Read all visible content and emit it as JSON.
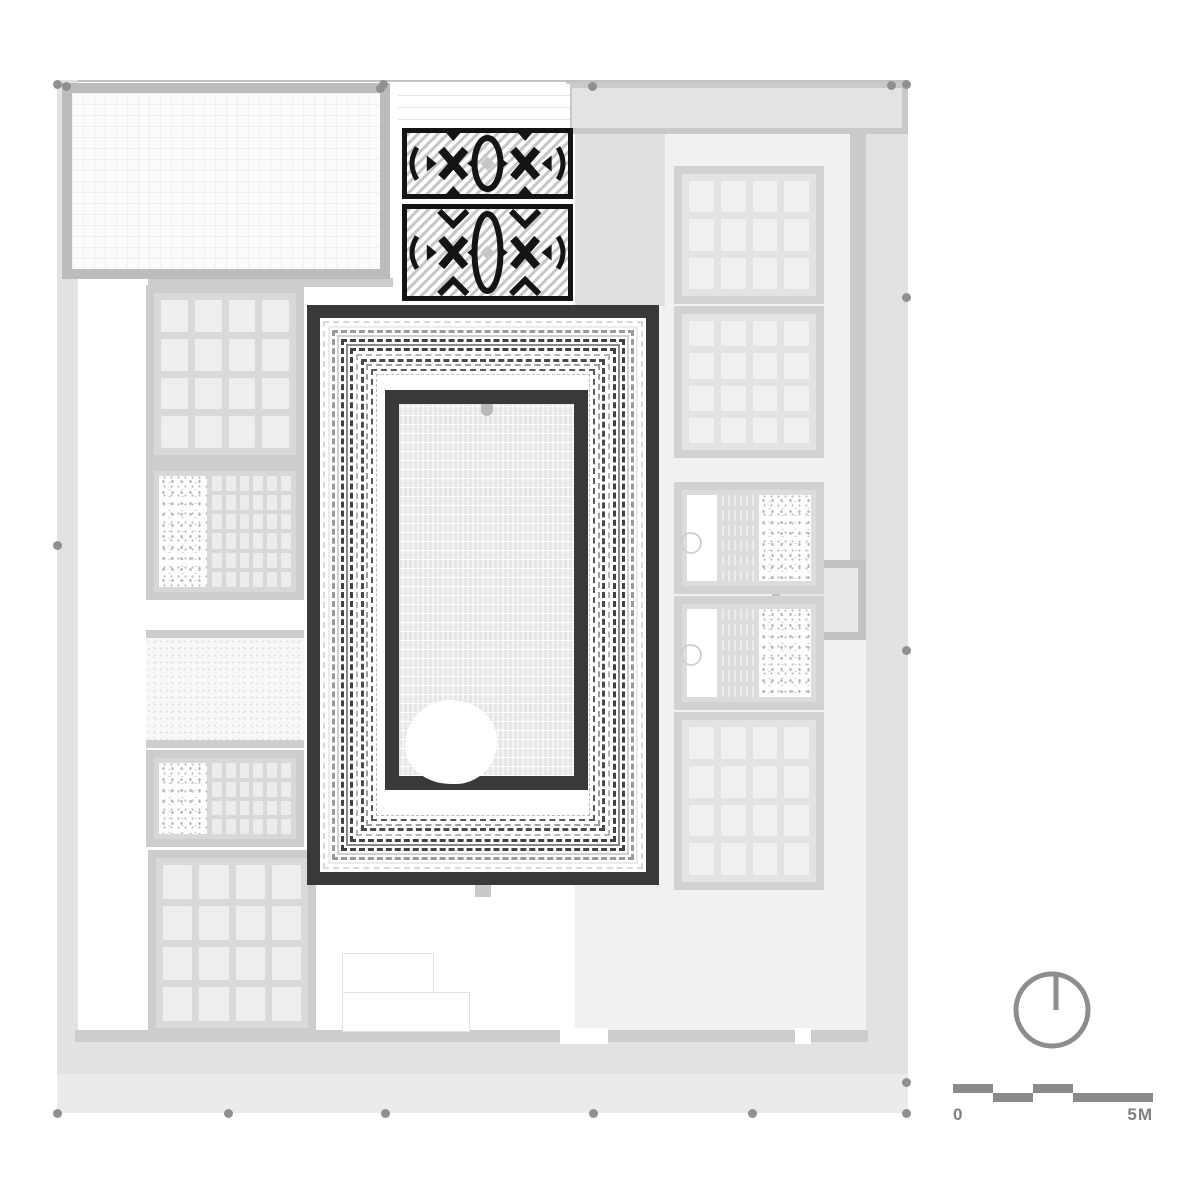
{
  "drawing": {
    "type": "architectural-roof-plan",
    "accent_dark": "#37393b",
    "wall_gray": "#cdcdcd",
    "terrace_gray": "#e2e2e2",
    "ornament_black": "#141414",
    "ornament_stripe": "#c6c6c6"
  },
  "scalebar": {
    "start_label": "0",
    "end_label": "5M",
    "color": "#8a8a8a",
    "x": 953,
    "y": 1084,
    "length": 200,
    "seg_h": 9,
    "segments": [
      {
        "off": 0,
        "w": 40,
        "row": "top"
      },
      {
        "off": 40,
        "w": 40,
        "row": "bot"
      },
      {
        "off": 80,
        "w": 40,
        "row": "top"
      },
      {
        "off": 120,
        "w": 80,
        "row": "bot"
      }
    ]
  },
  "north_arrow": {
    "cx": 1052,
    "cy": 1010,
    "r": 36,
    "stroke": "#8d8d8d",
    "stroke_w": 5
  },
  "geometry": {
    "site": {
      "x": 57,
      "y": 80,
      "w": 851,
      "h": 1033,
      "stroke": "#c2c2c2"
    },
    "rects": [
      {
        "name": "west-terrace",
        "x": 57,
        "y": 80,
        "w": 21,
        "h": 1033,
        "fill": "#e2e2e2"
      },
      {
        "name": "east-terrace",
        "x": 866,
        "y": 82,
        "w": 42,
        "h": 1031,
        "fill": "#e2e2e2"
      },
      {
        "name": "south-terrace",
        "x": 57,
        "y": 1040,
        "w": 851,
        "h": 73,
        "fill": "#e2e2e2"
      },
      {
        "name": "south-terrace-light",
        "x": 57,
        "y": 1074,
        "w": 851,
        "h": 39,
        "fill": "#ebebeb"
      },
      {
        "name": "north-entry-block",
        "x": 566,
        "y": 82,
        "w": 342,
        "h": 52,
        "fill": "#e3e3e3",
        "bw": 6,
        "bc": "#c9c9c9"
      },
      {
        "name": "right-wing-bg",
        "x": 575,
        "y": 134,
        "w": 291,
        "h": 906,
        "fill": "#f1f1f1"
      },
      {
        "name": "right-mid-band",
        "x": 575,
        "y": 134,
        "w": 90,
        "h": 172,
        "fill": "#e0e0e0"
      },
      {
        "name": "east-wall",
        "x": 850,
        "y": 134,
        "w": 16,
        "h": 434,
        "fill": "#cbcbcb"
      },
      {
        "name": "east-annex",
        "x": 772,
        "y": 560,
        "w": 94,
        "h": 80,
        "fill": "#e8e8e8",
        "bw": 8,
        "bc": "#c2c2c2"
      },
      {
        "name": "west-wall-band",
        "x": 148,
        "y": 278,
        "w": 245,
        "h": 9,
        "fill": "#cdcdcd"
      },
      {
        "name": "south-wall-band",
        "x": 75,
        "y": 1030,
        "w": 793,
        "h": 12,
        "fill": "#cdcdcd"
      },
      {
        "name": "south-door-gap",
        "x": 560,
        "y": 1028,
        "w": 48,
        "h": 16,
        "fill": "#ffffff"
      },
      {
        "name": "south-door-gap-2",
        "x": 795,
        "y": 1028,
        "w": 16,
        "h": 16,
        "fill": "#ffffff"
      },
      {
        "name": "axis-tab-south",
        "x": 475,
        "y": 885,
        "w": 16,
        "h": 12,
        "fill": "#c9c9c9"
      }
    ],
    "great_hall": {
      "x": 62,
      "y": 83,
      "w": 328,
      "h": 196,
      "bw": 10,
      "wall": "#bcbcbc"
    },
    "entrance": {
      "x": 398,
      "y": 84,
      "w": 172,
      "h": 44
    },
    "rooms": [
      {
        "name": "room-tiles-L1",
        "kind": "tiles",
        "x": 146,
        "y": 285,
        "w": 158,
        "h": 178,
        "cols": 4,
        "rows": 4,
        "wall": "#cdcdcd",
        "bg": "#d9d9d9",
        "tile": "#eeeeee"
      },
      {
        "name": "room-hammam-L2",
        "kind": "combo",
        "x": 146,
        "y": 463,
        "w": 158,
        "h": 137,
        "wall": "#cdcdcd",
        "bg": "#d8d8d8",
        "parts": [
          {
            "t": "speckle",
            "w": 48
          },
          {
            "t": "grid",
            "cols": 6,
            "rows": 6
          }
        ]
      },
      {
        "name": "room-sand-L3",
        "kind": "sand",
        "x": 146,
        "y": 630,
        "w": 158,
        "h": 118,
        "wall": "#cdcdcd"
      },
      {
        "name": "room-hammam-L4",
        "kind": "combo",
        "x": 146,
        "y": 750,
        "w": 158,
        "h": 97,
        "wall": "#cdcdcd",
        "bg": "#d8d8d8",
        "parts": [
          {
            "t": "speckle",
            "w": 48
          },
          {
            "t": "grid",
            "cols": 6,
            "rows": 4
          }
        ]
      },
      {
        "name": "room-tiles-L5",
        "kind": "tiles",
        "x": 148,
        "y": 850,
        "w": 168,
        "h": 186,
        "cols": 4,
        "rows": 4,
        "wall": "#cdcdcd",
        "bg": "#d9d9d9",
        "tile": "#eeeeee"
      },
      {
        "name": "room-tiles-R1",
        "kind": "tiles",
        "x": 674,
        "y": 166,
        "w": 150,
        "h": 138,
        "cols": 4,
        "rows": 3,
        "wall": "#d2d2d2",
        "bg": "#e3e3e3",
        "tile": "#f0f0f0"
      },
      {
        "name": "room-tiles-R2",
        "kind": "tiles",
        "x": 674,
        "y": 306,
        "w": 150,
        "h": 152,
        "cols": 4,
        "rows": 4,
        "wall": "#d2d2d2",
        "bg": "#e3e3e3",
        "tile": "#f0f0f0"
      },
      {
        "name": "room-hammam-R3",
        "kind": "combo",
        "x": 674,
        "y": 482,
        "w": 150,
        "h": 112,
        "wall": "#d2d2d2",
        "bg": "#dcdcdc",
        "parts": [
          {
            "t": "blank",
            "w": 30
          },
          {
            "t": "grid",
            "cols": 6,
            "rows": 6
          },
          {
            "t": "speckle",
            "w": 52
          }
        ]
      },
      {
        "name": "room-hammam-R4",
        "kind": "combo",
        "x": 674,
        "y": 596,
        "w": 150,
        "h": 114,
        "wall": "#d2d2d2",
        "bg": "#dcdcdc",
        "parts": [
          {
            "t": "blank",
            "w": 30
          },
          {
            "t": "grid",
            "cols": 6,
            "rows": 6
          },
          {
            "t": "speckle",
            "w": 52
          }
        ]
      },
      {
        "name": "room-tiles-R5",
        "kind": "tiles",
        "x": 674,
        "y": 712,
        "w": 150,
        "h": 178,
        "cols": 4,
        "rows": 4,
        "wall": "#d2d2d2",
        "bg": "#e3e3e3",
        "tile": "#f0f0f0"
      }
    ],
    "stairs": [
      {
        "x": 342,
        "y": 953,
        "w": 92,
        "h": 76
      },
      {
        "x": 342,
        "y": 992,
        "w": 128,
        "h": 40
      }
    ],
    "basins": [
      {
        "x": 691,
        "y": 543,
        "r": 11
      },
      {
        "x": 691,
        "y": 655,
        "r": 11
      }
    ],
    "dots": {
      "color": "#909090",
      "points": [
        [
          57,
          84
        ],
        [
          383,
          84
        ],
        [
          592,
          86
        ],
        [
          891,
          85
        ],
        [
          906,
          84
        ],
        [
          906,
          297
        ],
        [
          906,
          650
        ],
        [
          906,
          1082
        ],
        [
          57,
          545
        ],
        [
          57,
          1113
        ],
        [
          228,
          1113
        ],
        [
          385,
          1113
        ],
        [
          593,
          1113
        ],
        [
          752,
          1113
        ],
        [
          906,
          1113
        ],
        [
          66,
          86
        ],
        [
          380,
          88
        ]
      ]
    },
    "monument": {
      "x": 307,
      "y": 305,
      "w": 352,
      "h": 580,
      "frame": 13,
      "color": "#37393b",
      "rings": [
        {
          "inset": 3,
          "w": 2,
          "style": "dashed",
          "color": "#d8d8d8"
        },
        {
          "inset": 8,
          "w": 2,
          "style": "solid",
          "color": "#ebebeb"
        },
        {
          "inset": 12,
          "w": 3,
          "style": "dashed",
          "color": "#9a9a9a"
        },
        {
          "inset": 17,
          "w": 2,
          "style": "solid",
          "color": "#d0d0d0"
        },
        {
          "inset": 21,
          "w": 3,
          "style": "dashed",
          "color": "#3f4142"
        },
        {
          "inset": 26,
          "w": 2,
          "style": "solid",
          "color": "#8a8a8a"
        },
        {
          "inset": 30,
          "w": 3,
          "style": "dashed",
          "color": "#3f4142"
        },
        {
          "inset": 36,
          "w": 2,
          "style": "dashed",
          "color": "#b5b5b5"
        },
        {
          "inset": 41,
          "w": 3,
          "style": "dashed",
          "color": "#4a4a4a"
        },
        {
          "inset": 46,
          "w": 2,
          "style": "dashed",
          "color": "#9e9e9e"
        },
        {
          "inset": 51,
          "w": 2,
          "style": "dashed",
          "color": "#5a5a5a"
        },
        {
          "inset": 56,
          "w": 1,
          "style": "dashed",
          "color": "#bbbbbb"
        }
      ],
      "pool": {
        "left": 65,
        "top": 72,
        "w": 203,
        "h": 400,
        "frame": 14,
        "blob": {
          "left": 6,
          "top": 296,
          "w": 92,
          "h": 84
        },
        "dot_color": "#b9b9b9"
      }
    },
    "panels": [
      {
        "name": "kilim-panel-north",
        "x": 402,
        "y": 128,
        "w": 171,
        "h": 71,
        "kind": "narrow"
      },
      {
        "name": "kilim-panel-south",
        "x": 402,
        "y": 204,
        "w": 171,
        "h": 97,
        "kind": "tall"
      }
    ]
  }
}
